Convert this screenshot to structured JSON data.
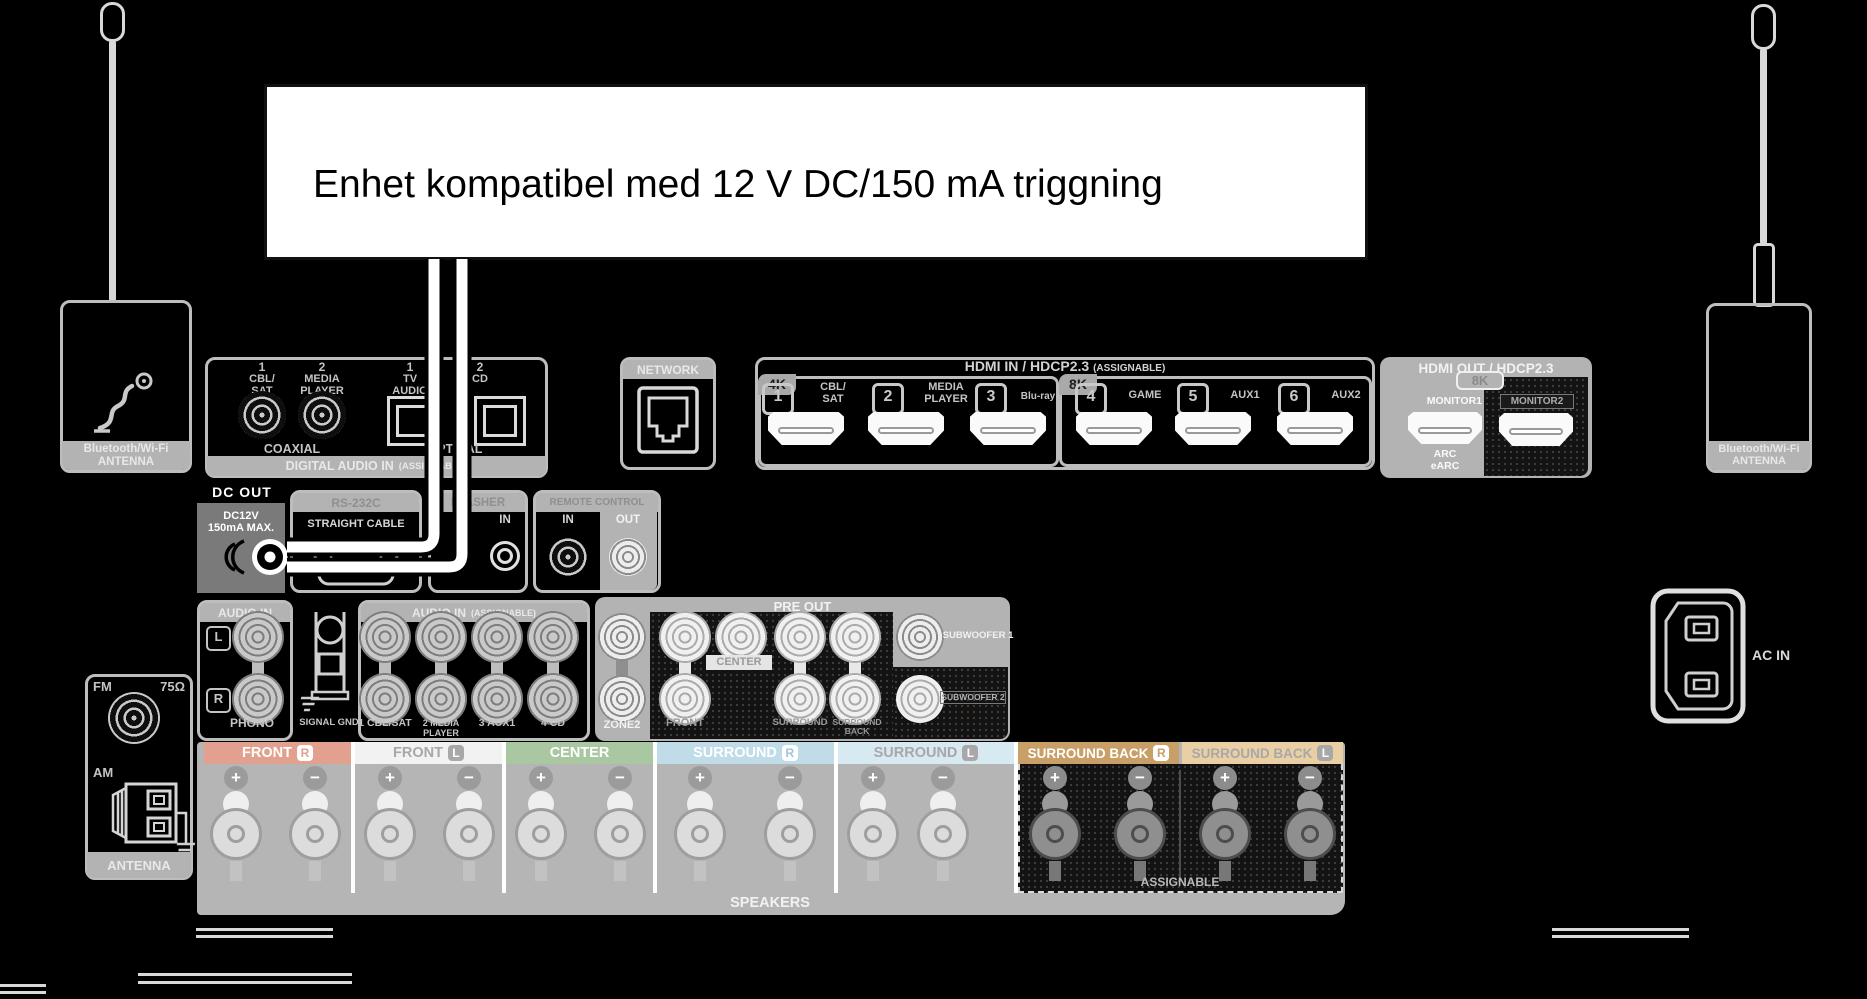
{
  "callout": {
    "text": "Enhet kompatibel med 12 V DC/150 mA triggning"
  },
  "antenna_left": {
    "line1": "Bluetooth/Wi-Fi",
    "line2": "ANTENNA"
  },
  "antenna_right": {
    "line1": "Bluetooth/Wi-Fi",
    "line2": "ANTENNA"
  },
  "digital_audio": {
    "ports": [
      {
        "num": "1",
        "label": "CBL/\nSAT"
      },
      {
        "num": "2",
        "label": "MEDIA\nPLAYER"
      },
      {
        "num": "1",
        "label": "TV\nAUDIO"
      },
      {
        "num": "2",
        "label": "CD"
      }
    ],
    "coaxial": "COAXIAL",
    "optical": "OPTICAL",
    "footer": "DIGITAL AUDIO IN",
    "footer_note": "(ASSIGNABLE)"
  },
  "network": {
    "header": "NETWORK"
  },
  "hdmi_in": {
    "header": "HDMI IN / HDCP2.3",
    "header_note": "(ASSIGNABLE)",
    "badge_4k": "4K",
    "badge_8k": "8K",
    "ports": [
      {
        "num": "1",
        "label": "CBL/\nSAT"
      },
      {
        "num": "2",
        "label": "MEDIA\nPLAYER"
      },
      {
        "num": "3",
        "label": "Blu-ray"
      },
      {
        "num": "4",
        "label": "GAME"
      },
      {
        "num": "5",
        "label": "AUX1"
      },
      {
        "num": "6",
        "label": "AUX2"
      }
    ]
  },
  "hdmi_out": {
    "header": "HDMI OUT / HDCP2.3",
    "badge_8k": "8K",
    "monitor1": "MONITOR1",
    "monitor2": "MONITOR2",
    "arc": "ARC\neARC"
  },
  "dc_out": {
    "header": "DC OUT",
    "rating": "DC12V\n150mA MAX."
  },
  "rs232c": {
    "header": "RS-232C",
    "label": "STRAIGHT CABLE"
  },
  "flasher": {
    "header": "FLASHER",
    "in": "IN"
  },
  "remote": {
    "header": "REMOTE CONTROL",
    "in": "IN",
    "out": "OUT"
  },
  "audio_in": {
    "header": "AUDIO IN",
    "l": "L",
    "r": "R",
    "phono": "PHONO",
    "gnd": "SIGNAL GND"
  },
  "audio_in2": {
    "header": "AUDIO IN",
    "note": "(ASSIGNABLE)",
    "labels": [
      "1 CBL/SAT",
      "2 MEDIA PLAYER",
      "3 AUX1",
      "4 CD"
    ]
  },
  "pre_out": {
    "header": "PRE OUT",
    "zone2": "ZONE2",
    "front": "FRONT",
    "center": "CENTER",
    "surround": "SURROUND",
    "surround_back": "SURROUND BACK",
    "sub1": "SUBWOOFER 1",
    "sub2": "SUBWOOFER 2"
  },
  "tuner": {
    "fm": "FM",
    "ohm": "75Ω",
    "am": "AM",
    "footer": "ANTENNA"
  },
  "speakers": {
    "footer": "SPEAKERS",
    "assignable": "ASSIGNABLE",
    "plus": "+",
    "minus": "−",
    "channels": [
      {
        "label": "FRONT",
        "side": "R",
        "bg": "#E2A18F",
        "fg": "#FFFFFF",
        "badge_bg": "#FFFFFF",
        "badge_fg": "#E2A18F"
      },
      {
        "label": "FRONT",
        "side": "L",
        "bg": "#F2F2F2",
        "fg": "#A8A8A8",
        "badge_bg": "#A8A8A8",
        "badge_fg": "#FFFFFF"
      },
      {
        "label": "CENTER",
        "side": "",
        "bg": "#A9C7A0",
        "fg": "#FFFFFF",
        "badge_bg": "#FFFFFF",
        "badge_fg": "#A9C7A0"
      },
      {
        "label": "SURROUND",
        "side": "R",
        "bg": "#BFDCE8",
        "fg": "#FFFFFF",
        "badge_bg": "#FFFFFF",
        "badge_fg": "#9FC6D6"
      },
      {
        "label": "SURROUND",
        "side": "L",
        "bg": "#D7E9F1",
        "fg": "#A8A8A8",
        "badge_bg": "#A8A8A8",
        "badge_fg": "#FFFFFF"
      },
      {
        "label": "SURROUND BACK",
        "side": "R",
        "bg": "#C89F67",
        "fg": "#FFFFFF",
        "badge_bg": "#FFFFFF",
        "badge_fg": "#C89F67"
      },
      {
        "label": "SURROUND BACK",
        "side": "L",
        "bg": "#EACFA5",
        "fg": "#A8A8A8",
        "badge_bg": "#A8A8A8",
        "badge_fg": "#FFFFFF"
      }
    ]
  },
  "ac_in": {
    "label": "AC IN"
  },
  "colors": {
    "panel_gray": "#B3B3B3",
    "line_gray": "#C4C4C4",
    "dark_fill": "#141414",
    "dc_box_gray": "#7A7A7A"
  }
}
